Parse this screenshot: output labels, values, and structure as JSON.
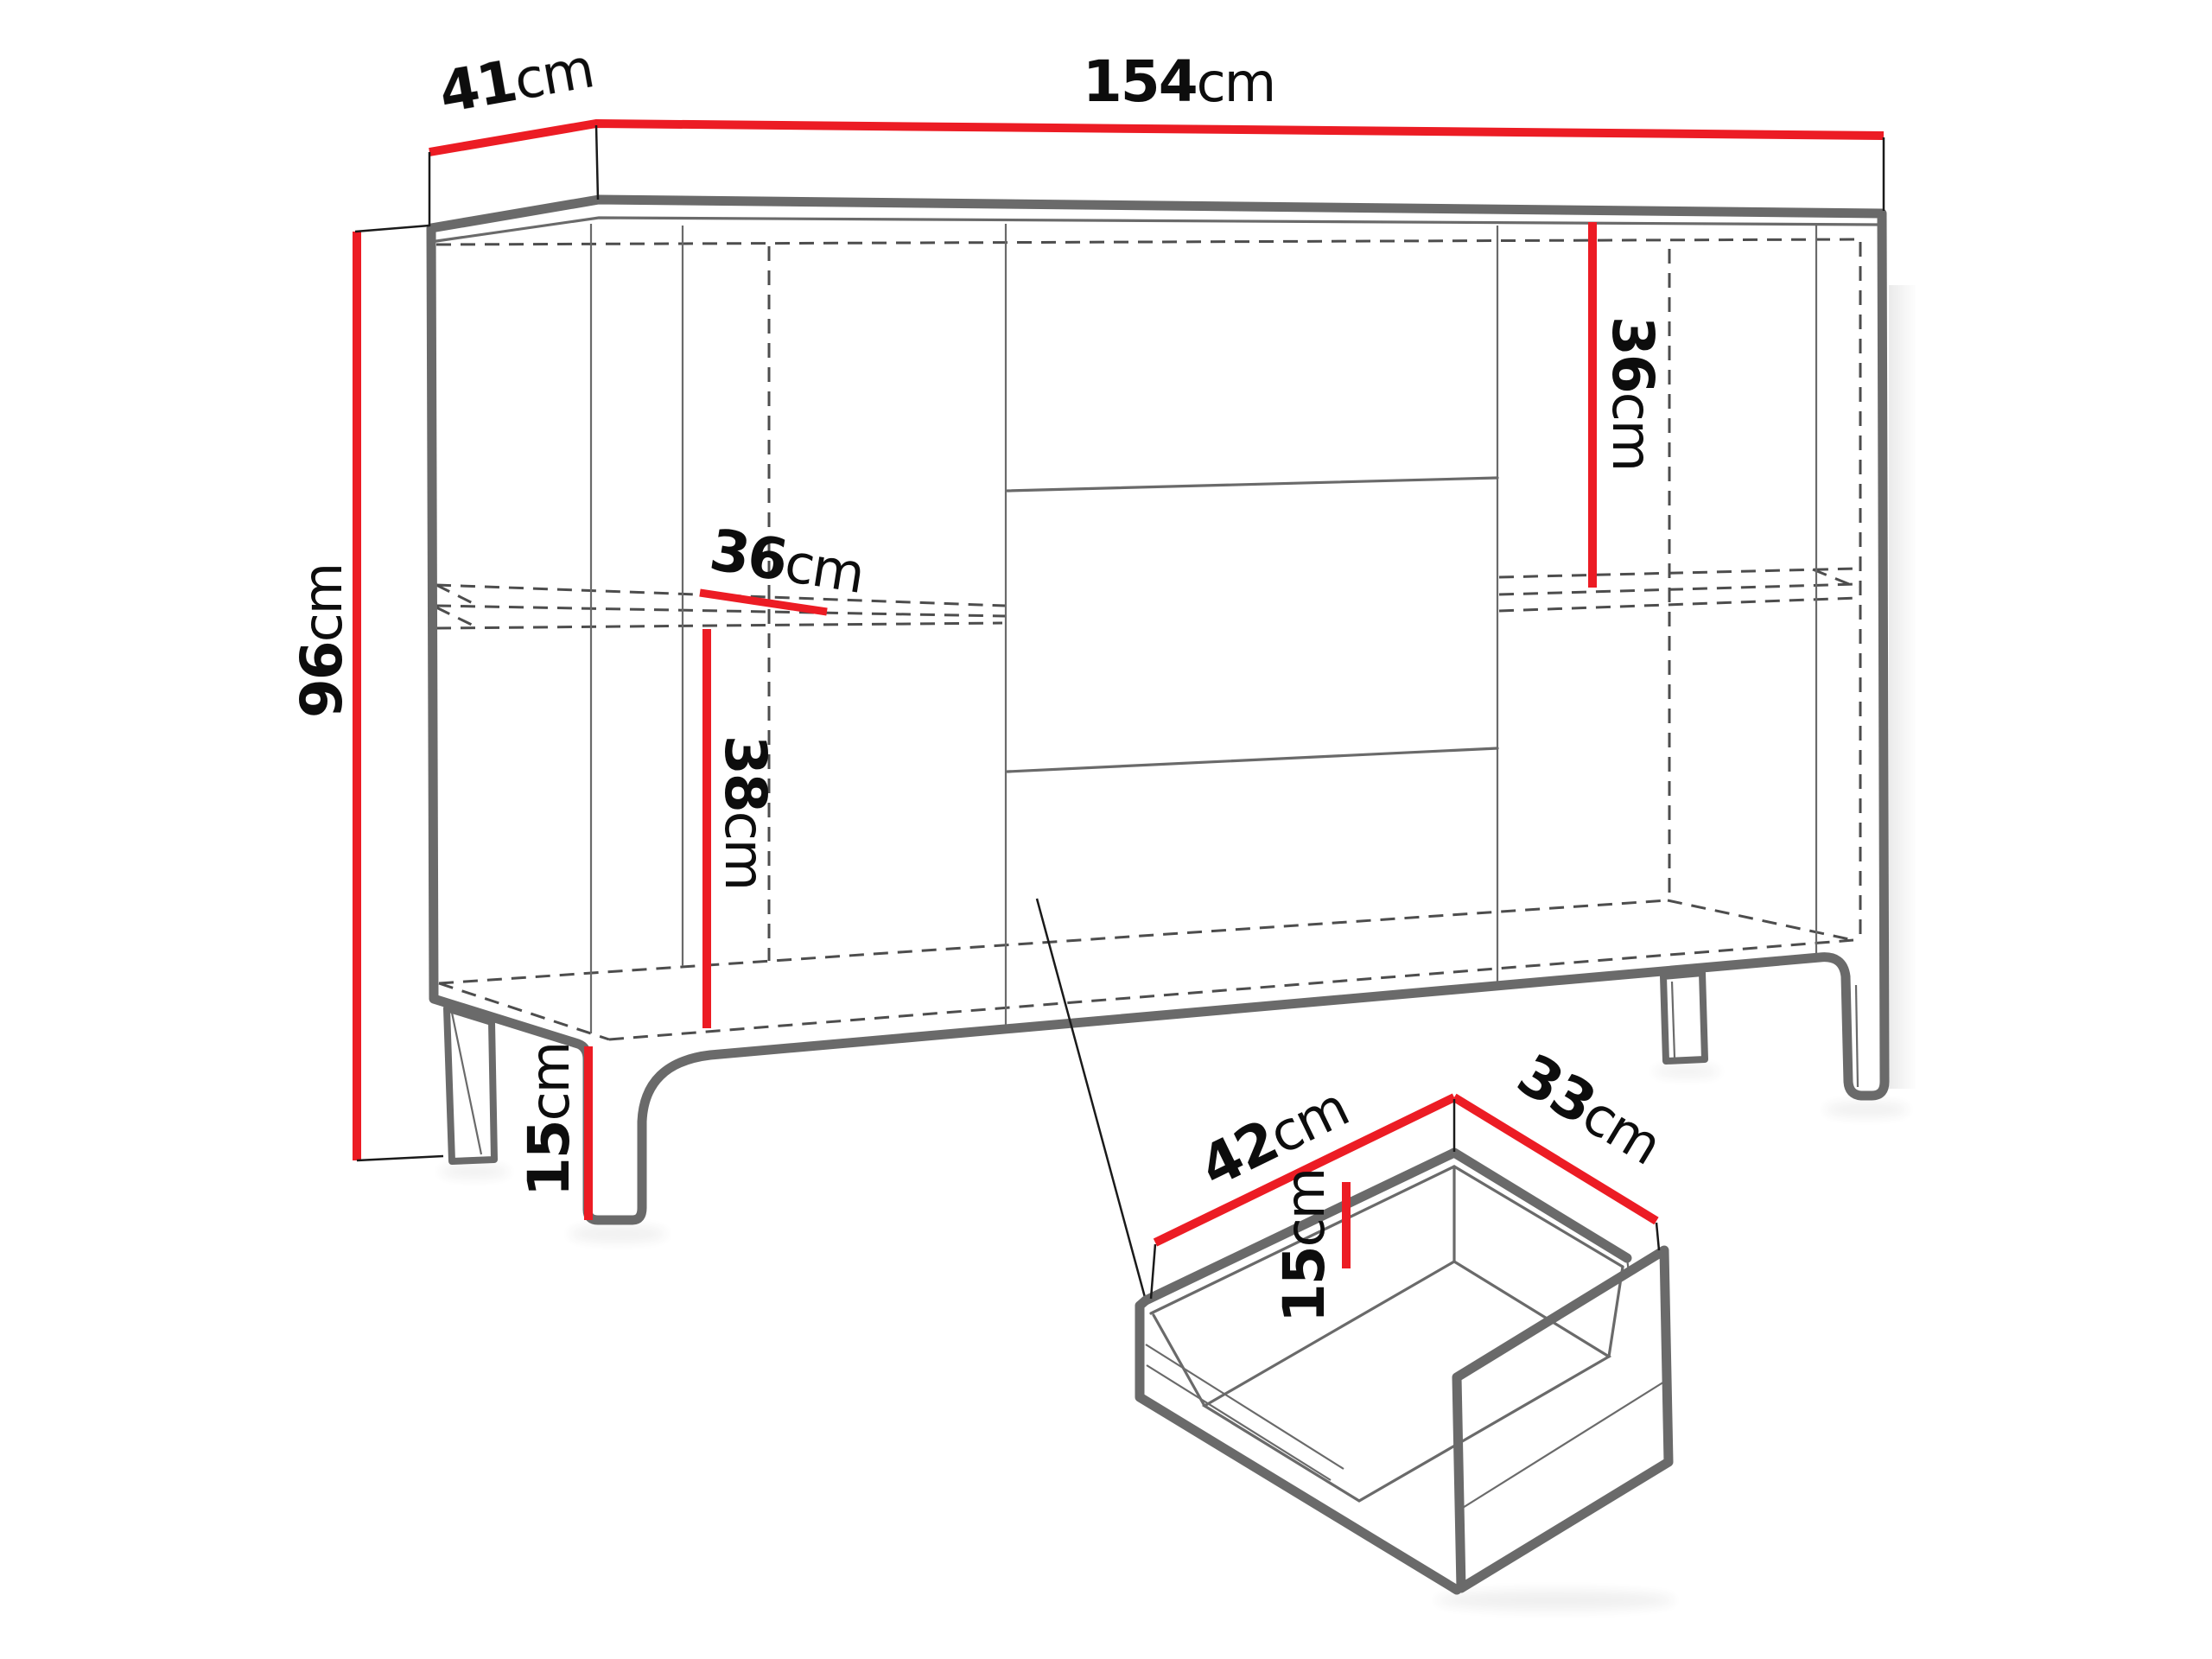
{
  "diagram": {
    "kind": "furniture-dimension-diagram",
    "subject": "sideboard cabinet with legs and pull-out drawer detail",
    "unit": "cm",
    "accent_color": "#EC1C24",
    "outline_color": "#6A6A6A",
    "hidden_edge_style": "dashed",
    "background": "#ffffff"
  },
  "labels": {
    "depth_top": {
      "num": "41",
      "unit": "cm"
    },
    "width_top": {
      "num": "154",
      "unit": "cm"
    },
    "height_left": {
      "num": "96",
      "unit": "cm"
    },
    "shelf_depth_left": {
      "num": "36",
      "unit": "cm"
    },
    "shelf_clearance_left": {
      "num": "38",
      "unit": "cm"
    },
    "leg_height": {
      "num": "15",
      "unit": "cm"
    },
    "shelf_height_right": {
      "num": "36",
      "unit": "cm"
    },
    "drawer_width": {
      "num": "42",
      "unit": "cm"
    },
    "drawer_depth": {
      "num": "33",
      "unit": "cm"
    },
    "drawer_height": {
      "num": "15",
      "unit": "cm"
    }
  }
}
